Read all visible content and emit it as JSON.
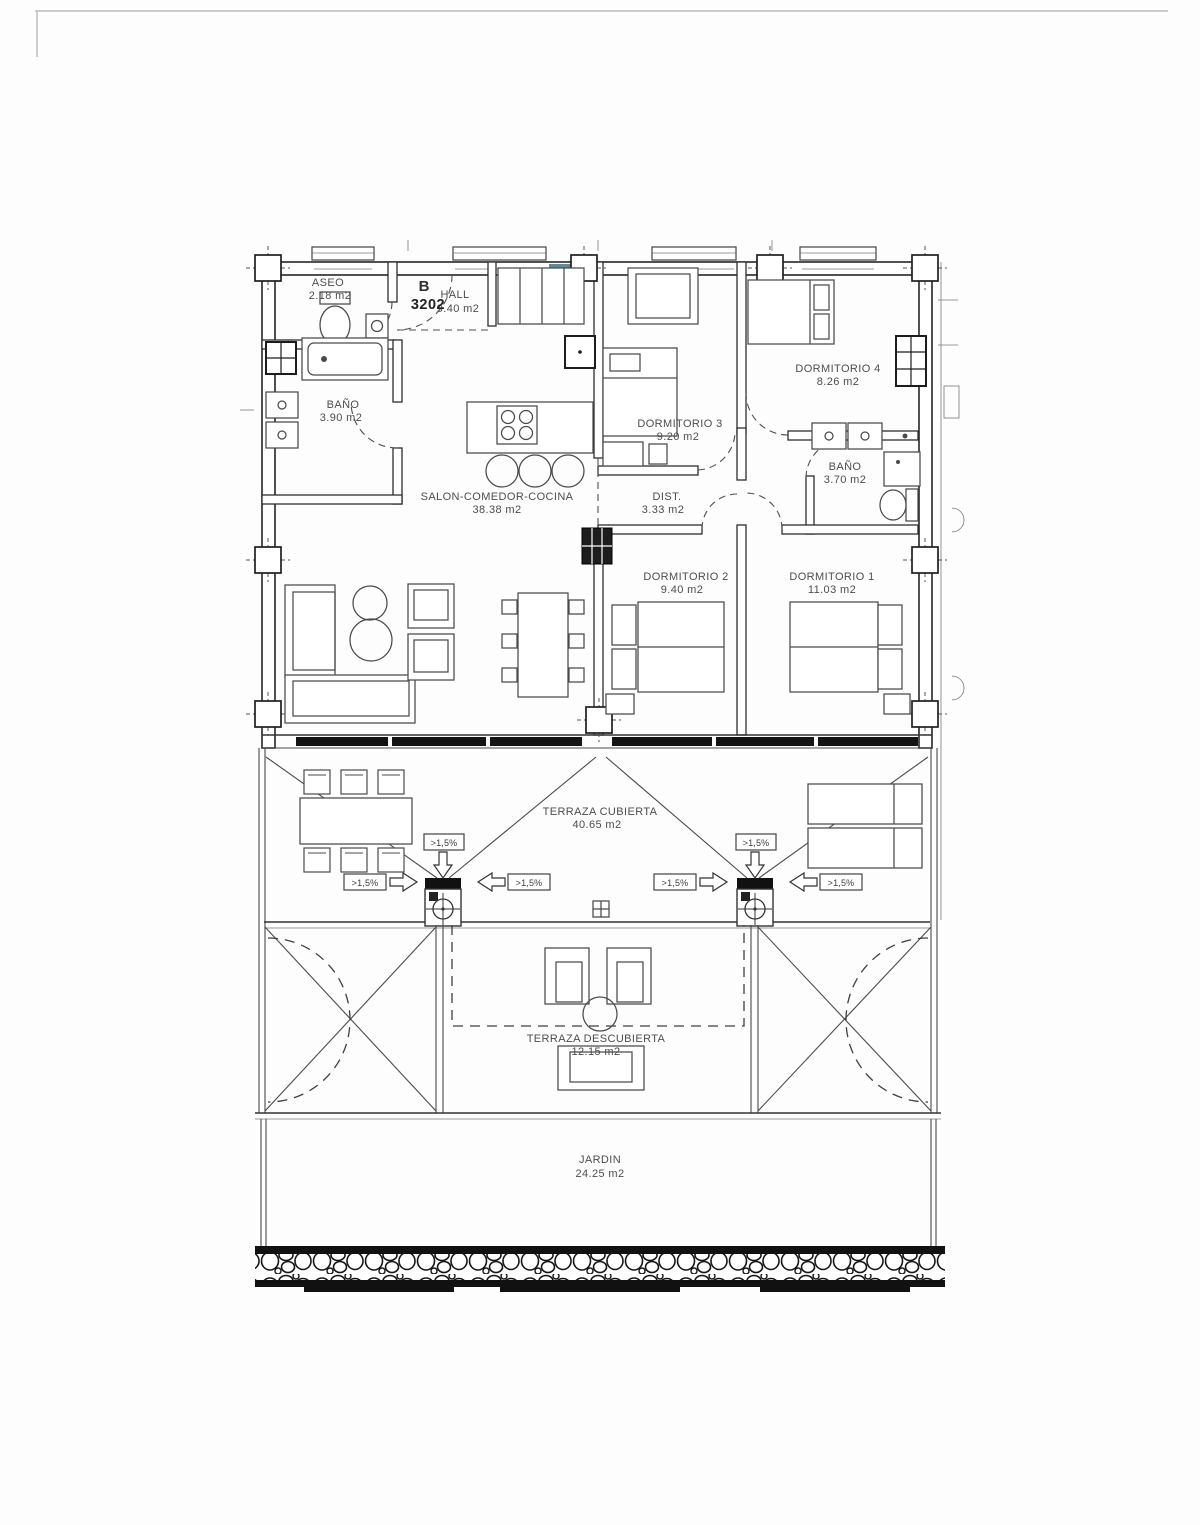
{
  "unit": {
    "block": "B",
    "number": "3202"
  },
  "rooms": {
    "aseo": {
      "name": "ASEO",
      "area": "2.18 m2"
    },
    "hall": {
      "name": "HALL",
      "area": "9.40 m2"
    },
    "bano1": {
      "name": "BAÑO",
      "area": "3.90 m2"
    },
    "salon": {
      "name": "SALON-COMEDOR-COCINA",
      "area": "38.38 m2"
    },
    "dorm3": {
      "name": "DORMITORIO 3",
      "area": "9.20 m2"
    },
    "dorm4": {
      "name": "DORMITORIO 4",
      "area": "8.26 m2"
    },
    "bano2": {
      "name": "BAÑO",
      "area": "3.70 m2"
    },
    "dist": {
      "name": "DIST.",
      "area": "3.33 m2"
    },
    "dorm2": {
      "name": "DORMITORIO 2",
      "area": "9.40 m2"
    },
    "dorm1": {
      "name": "DORMITORIO 1",
      "area": "11.03 m2"
    },
    "terraza_cub": {
      "name": "TERRAZA CUBIERTA",
      "area": "40.65 m2"
    },
    "terraza_des": {
      "name": "TERRAZA DESCUBIERTA",
      "area": "12.15 m2"
    },
    "jardin": {
      "name": "JARDIN",
      "area": "24.25 m2"
    }
  },
  "slope": {
    "label": ">1,5%"
  },
  "colors": {
    "accent_window": "#4e7d8c",
    "line": "#3a3a3a",
    "text": "#4d4d4d",
    "paper": "#fdfdfd"
  }
}
